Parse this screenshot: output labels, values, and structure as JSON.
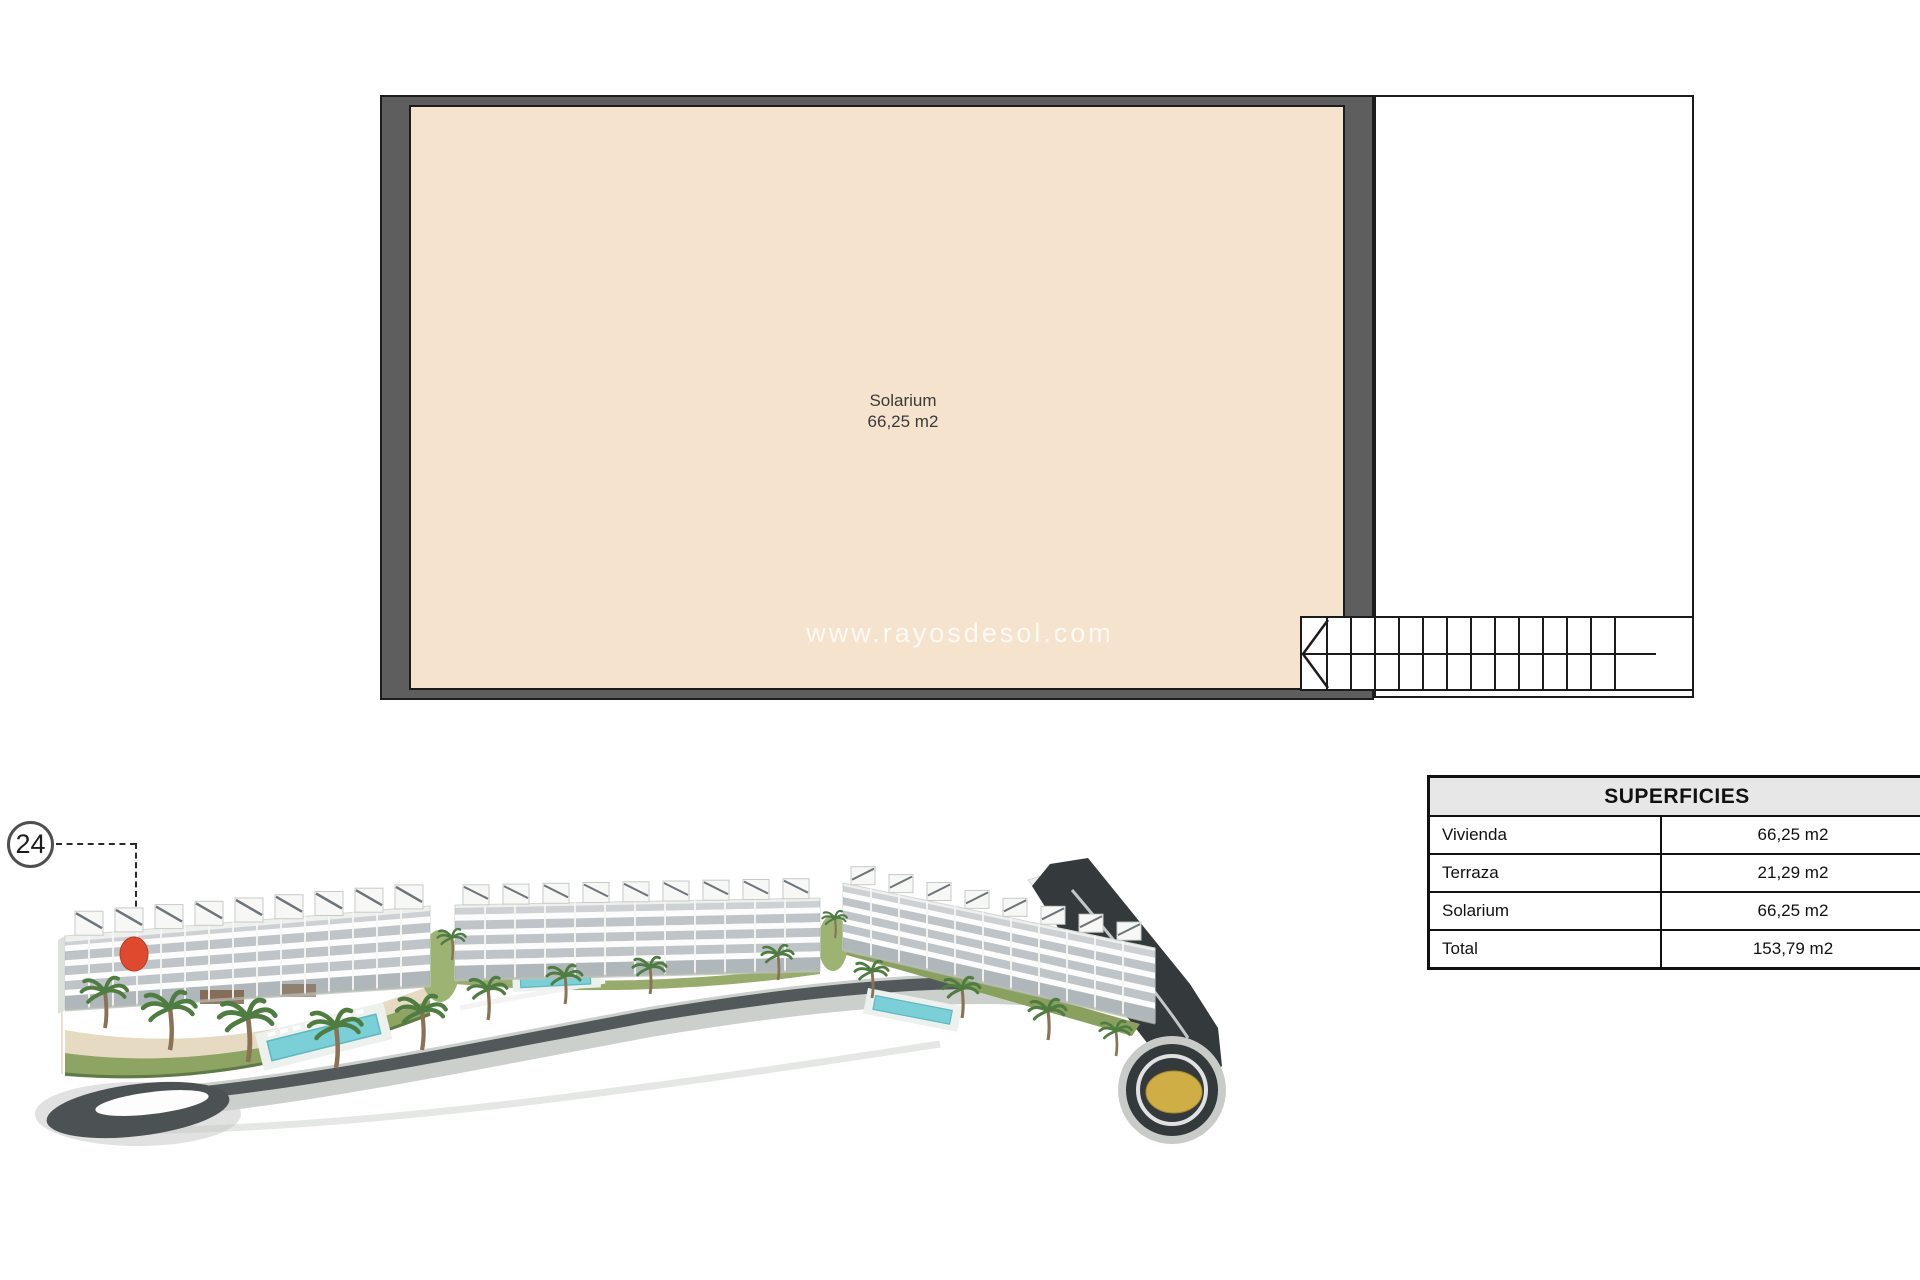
{
  "plan": {
    "room": {
      "name": "Solarium",
      "area": "66,25 m2"
    },
    "watermark": "www.rayosdesol.com"
  },
  "badge": {
    "number": "24"
  },
  "table": {
    "title": "SUPERFICIES",
    "rows": [
      {
        "label": "Vivienda",
        "value": "66,25 m2"
      },
      {
        "label": "Terraza",
        "value": "21,29 m2"
      },
      {
        "label": "Solarium",
        "value": "66,25 m2"
      },
      {
        "label": "Total",
        "value": "153,79 m2"
      }
    ]
  },
  "colors": {
    "wall": "#5e5e5e",
    "floor": "#f5e3cd",
    "header_bg": "#e7e7e7",
    "marker_red": "#df4a2f",
    "roundabout_gold": "#cfae45",
    "road_dark": "#34393c",
    "pool_blue": "#7ad0d6"
  }
}
